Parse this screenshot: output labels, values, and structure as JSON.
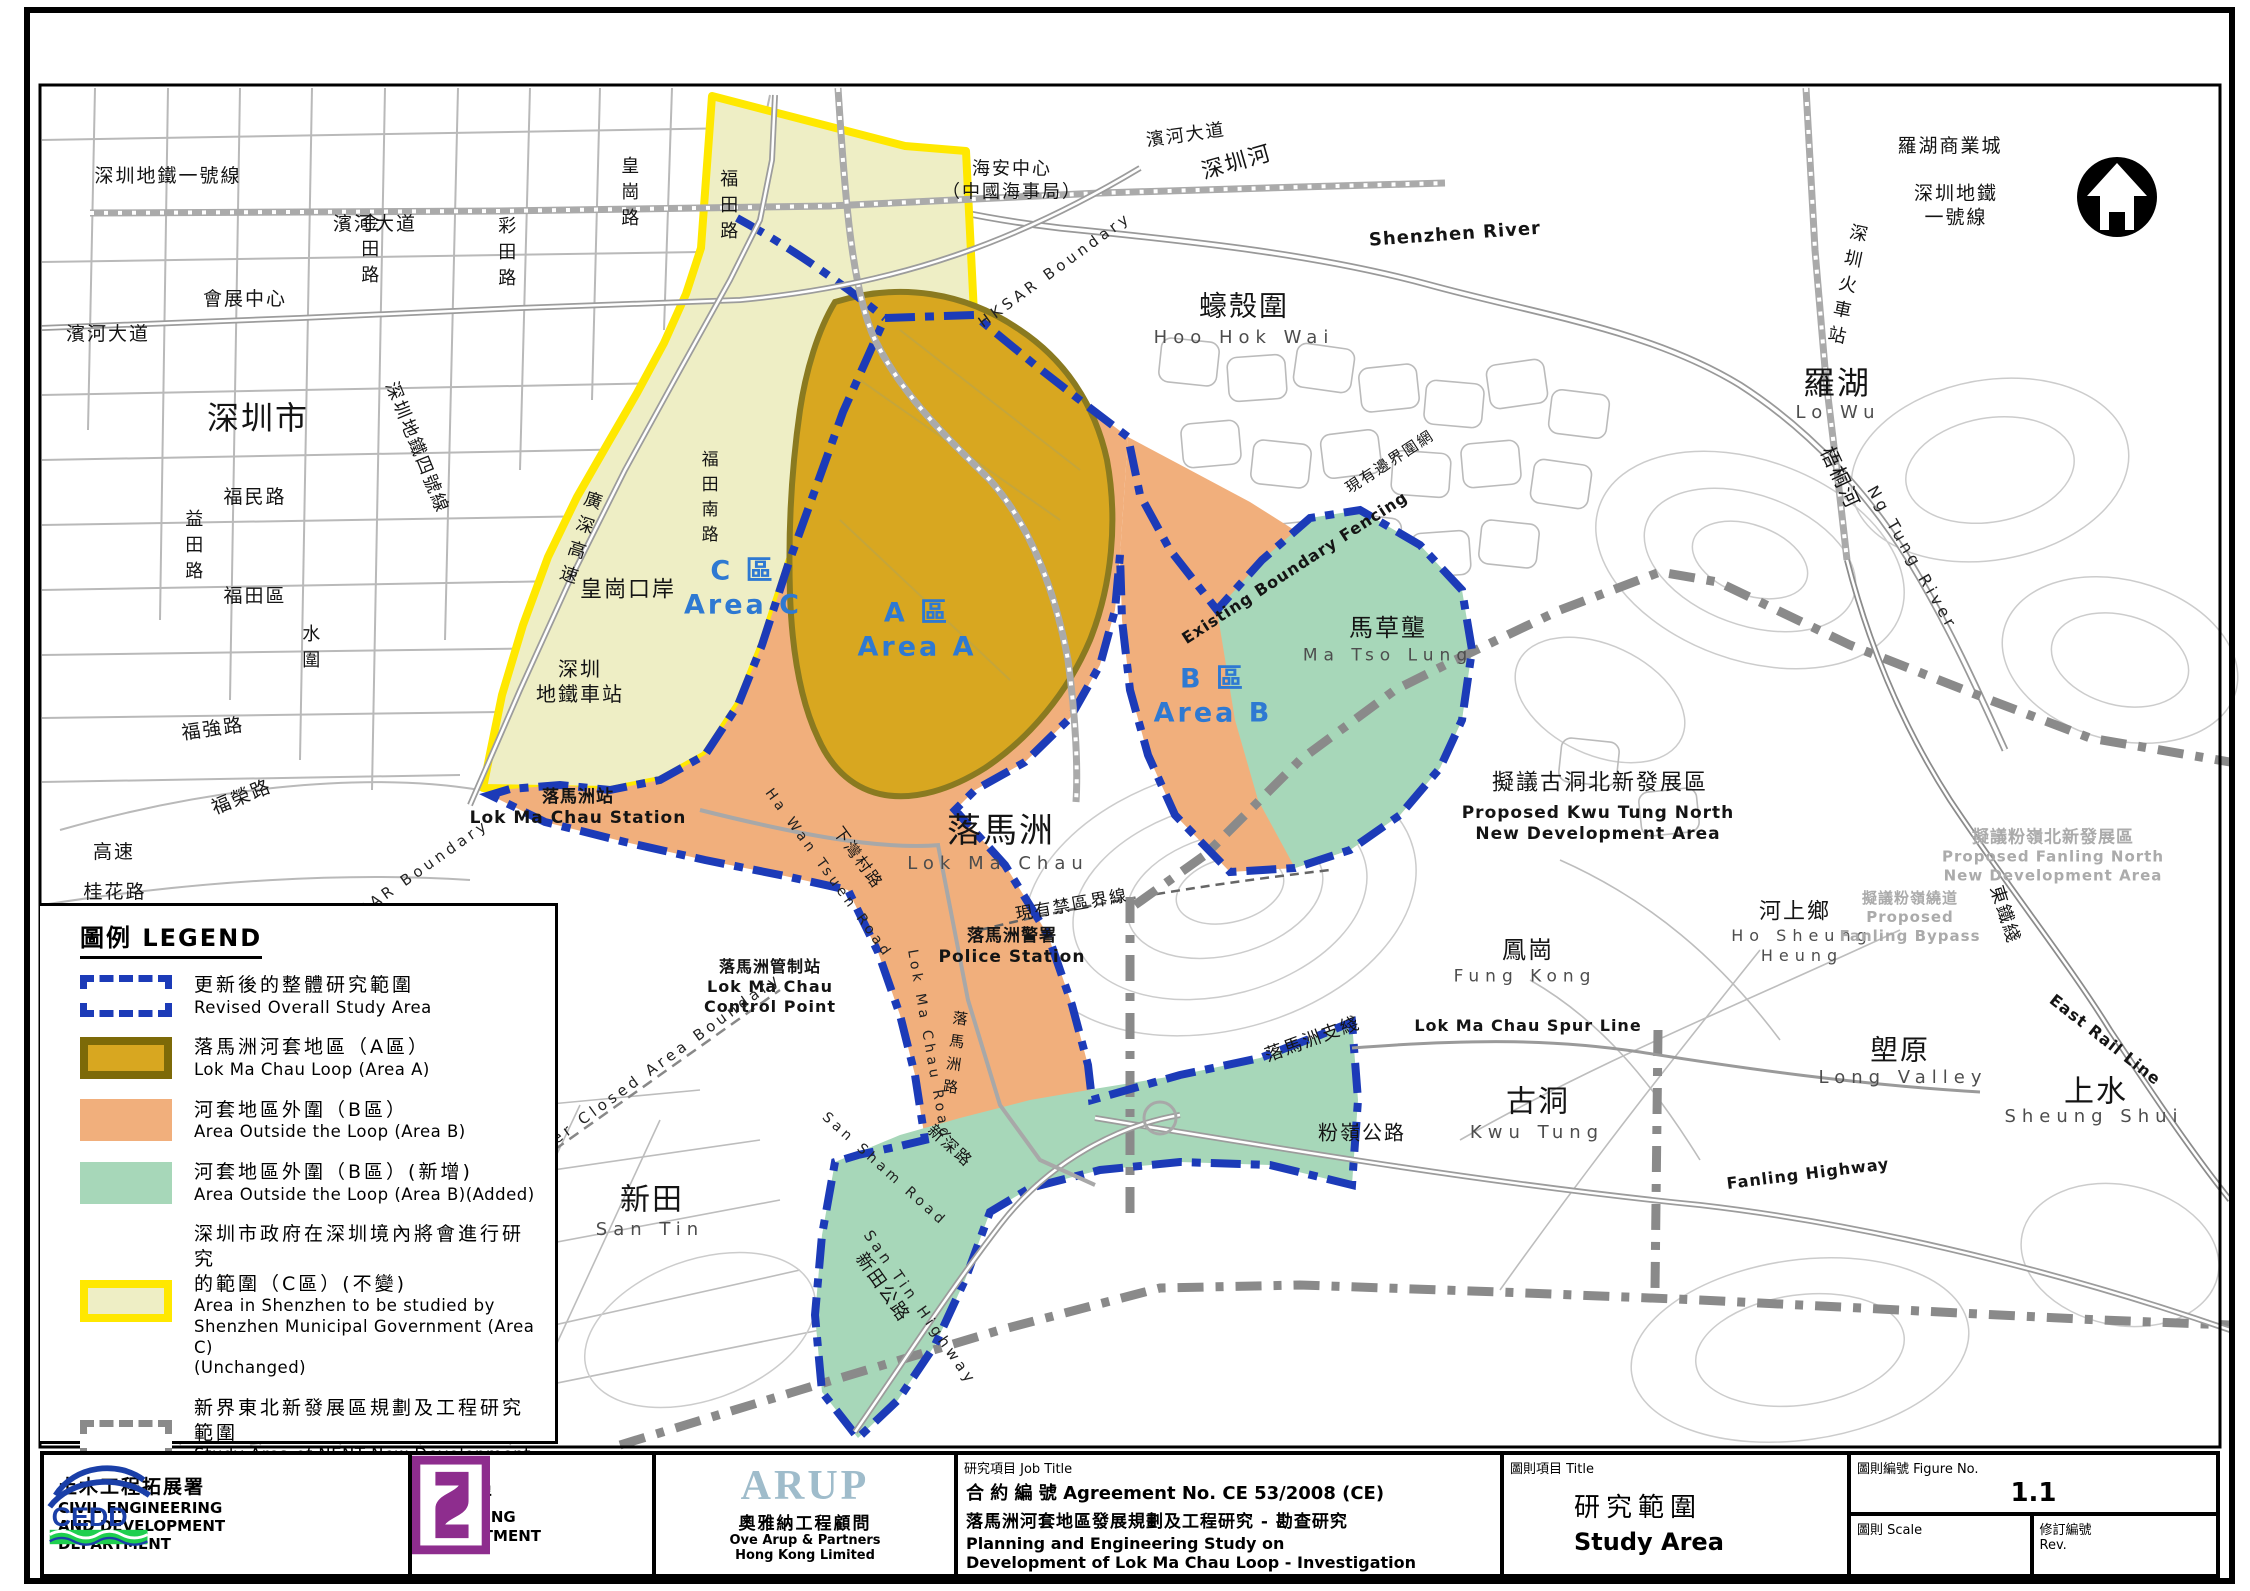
{
  "figure": {
    "number": "1.1"
  },
  "colors": {
    "area_a_fill": "#D8A720",
    "area_a_border": "#7D6A08",
    "area_b_fill": "#F1AF7C",
    "area_b_added_fill": "#A7D7B9",
    "area_c_fill": "#EEEEC5",
    "area_c_border": "#FFE800",
    "study_boundary_blue": "#1C3BB8",
    "nent_boundary_gray": "#8a8a8a",
    "area_label_blue": "#2E79D2"
  },
  "legend": {
    "title": "圖例 LEGEND",
    "items": [
      {
        "swatch": "revised",
        "zh": "更新後的整體研究範圍",
        "en": "Revised Overall Study Area"
      },
      {
        "swatch": "area-a",
        "zh": "落馬洲河套地區（A區）",
        "en": "Lok Ma Chau Loop (Area A)"
      },
      {
        "swatch": "area-b",
        "zh": "河套地區外圍（B區）",
        "en": "Area Outside the Loop (Area B)"
      },
      {
        "swatch": "area-b-added",
        "zh": "河套地區外圍（B區）(新增)",
        "en": "Area Outside the Loop (Area B)(Added)"
      },
      {
        "swatch": "area-c",
        "zh": "深圳市政府在深圳境內將會進行研究\n的範圍（C區）(不變)",
        "en": "Area in Shenzhen to be studied by\nShenzhen Municipal Government (Area C)\n(Unchanged)"
      },
      {
        "swatch": "nent",
        "zh": "新界東北新發展區規劃及工程研究範圍",
        "en": "Study Area of NENT New Development\nAreas Planning and Engineering Study"
      }
    ]
  },
  "title_block": {
    "cedd": {
      "zh": "土木工程拓展署",
      "en": "CIVIL ENGINEERING\nAND DEVELOPMENT\nDEPARTMENT",
      "abbr": "CEDD"
    },
    "planning": {
      "zh": "規劃署",
      "en": "PLANNING\nDEPARTMENT"
    },
    "arup": {
      "word": "ARUP",
      "zh": "奧雅納工程顧問",
      "en": "Ove Arup & Partners\nHong Kong Limited"
    },
    "job": {
      "label": "研究項目 Job Title",
      "agreement": "合 約 編 號 Agreement No. CE 53/2008 (CE)",
      "title_zh": "落馬洲河套地區發展規劃及工程研究 - 勘查研究",
      "title_en": "Planning and Engineering Study on\nDevelopment of Lok Ma Chau Loop - Investigation"
    },
    "drawing": {
      "label": "圖則項目 Title",
      "title_zh": "研究範圍",
      "title_en": "Study Area"
    },
    "figure": {
      "label": "圖則編號 Figure No.",
      "number": "1.1",
      "scale_label": "圖則 Scale",
      "scale_value": "",
      "rev_label": "修訂編號\nRev.",
      "rev_value": ""
    }
  },
  "map": {
    "labels": [
      {
        "id": "sz-metro-line-1",
        "text": "深圳地鐵一號線",
        "x": 168,
        "y": 177
      },
      {
        "id": "kam-tin-road",
        "text": "金田路",
        "x": 368,
        "y": 252,
        "cls": "vert",
        "fs": 18
      },
      {
        "id": "choi-tin-road",
        "text": "彩田路",
        "x": 505,
        "y": 255,
        "cls": "vert",
        "fs": 18
      },
      {
        "id": "wong-kong-road",
        "text": "皇崗路",
        "x": 628,
        "y": 195,
        "cls": "vert",
        "fs": 18
      },
      {
        "id": "fu-tin-road",
        "text": "福田路",
        "x": 727,
        "y": 208,
        "cls": "vert",
        "fs": 18
      },
      {
        "id": "convention-centre",
        "text": "會展中心",
        "x": 245,
        "y": 300
      },
      {
        "id": "binhe-blvd-west",
        "text": "濱河大道",
        "x": 108,
        "y": 335
      },
      {
        "id": "binhe-blvd-centre",
        "text": "濱河大道",
        "x": 375,
        "y": 225
      },
      {
        "id": "shenzhen-city",
        "text": "深圳市",
        "x": 258,
        "y": 418,
        "fs": 32
      },
      {
        "id": "fumin-road",
        "text": "福民路",
        "x": 255,
        "y": 498
      },
      {
        "id": "yitian-road",
        "text": "益田路",
        "x": 192,
        "y": 548,
        "cls": "vert",
        "fs": 18
      },
      {
        "id": "futian-district",
        "text": "福田區",
        "x": 255,
        "y": 597
      },
      {
        "id": "shui-wai",
        "text": "水圍",
        "x": 309,
        "y": 650,
        "cls": "vert",
        "fs": 18
      },
      {
        "id": "sz-metro-line-4",
        "text": "深圳地鐵四號線",
        "x": 416,
        "y": 448,
        "rot": 68,
        "fs": 18
      },
      {
        "id": "fuqiang-road",
        "text": "福強路",
        "x": 213,
        "y": 730,
        "rot": -8
      },
      {
        "id": "furong-road",
        "text": "福榮路",
        "x": 242,
        "y": 798,
        "rot": -22
      },
      {
        "id": "gaosu",
        "text": "高速",
        "x": 114,
        "y": 853
      },
      {
        "id": "guihua-road",
        "text": "桂花路",
        "x": 115,
        "y": 893
      },
      {
        "id": "guangshen-expressway",
        "text": "廣深高速",
        "x": 578,
        "y": 540,
        "cls": "vert",
        "rot": 18,
        "fs": 18
      },
      {
        "id": "futian-south-road",
        "text": "福田南路",
        "x": 707,
        "y": 500,
        "cls": "vert",
        "fs": 17
      },
      {
        "id": "hai-an-centre",
        "text": "海安中心\n（中國海事局）",
        "x": 1012,
        "y": 181,
        "fs": 18
      },
      {
        "id": "binhe-blvd-east",
        "text": "濱河大道",
        "x": 1186,
        "y": 136,
        "rot": -8,
        "fs": 18
      },
      {
        "id": "shenzhen-river-cjk",
        "text": "深圳河",
        "x": 1237,
        "y": 163,
        "rot": -16,
        "fs": 22
      },
      {
        "id": "shenzhen-river-en",
        "text": "Shenzhen River",
        "x": 1455,
        "y": 235,
        "rot": -4,
        "cls": "bold",
        "fs": 18
      },
      {
        "id": "hksar-boundary-north",
        "text": "HKSAR Boundary",
        "x": 1055,
        "y": 270,
        "rot": -36,
        "cls": "sp",
        "fs": 15
      },
      {
        "id": "hoo-hok-wai-cjk",
        "text": "蠔殼圍",
        "x": 1244,
        "y": 306,
        "fs": 28
      },
      {
        "id": "hoo-hok-wai-en",
        "text": "Hoo Hok Wai",
        "x": 1244,
        "y": 338,
        "cls": "thin",
        "fs": 18
      },
      {
        "id": "lo-wu-commercial-city",
        "text": "羅湖商業城",
        "x": 1950,
        "y": 147
      },
      {
        "id": "sz-metro-line-1-east",
        "text": "深圳地鐵\n一號線",
        "x": 1956,
        "y": 206
      },
      {
        "id": "sz-railway-station",
        "text": "深圳火車站",
        "x": 1845,
        "y": 287,
        "cls": "vert",
        "rot": 12,
        "fs": 18
      },
      {
        "id": "lo-wu-cjk",
        "text": "羅湖",
        "x": 1837,
        "y": 383,
        "fs": 32
      },
      {
        "id": "lo-wu-en",
        "text": "Lo Wu",
        "x": 1838,
        "y": 413,
        "cls": "thin",
        "fs": 18
      },
      {
        "id": "ng-tung-river-cjk",
        "text": "梧桐河",
        "x": 1840,
        "y": 478,
        "rot": 65,
        "fs": 20
      },
      {
        "id": "ng-tung-river-en",
        "text": "Ng Tung River",
        "x": 1912,
        "y": 558,
        "rot": 60,
        "cls": "sp",
        "fs": 16
      },
      {
        "id": "area-c",
        "text": "C 區\nArea C",
        "x": 743,
        "y": 588,
        "cls": "blue",
        "fs": 27
      },
      {
        "id": "area-a",
        "text": "A 區\nArea A",
        "x": 917,
        "y": 630,
        "cls": "blue",
        "fs": 27
      },
      {
        "id": "area-b",
        "text": "B 區\nArea B",
        "x": 1213,
        "y": 696,
        "cls": "blue",
        "fs": 27
      },
      {
        "id": "huanggang-port",
        "text": "皇崗口岸",
        "x": 628,
        "y": 590,
        "fs": 22
      },
      {
        "id": "sz-metro-terminus",
        "text": "深圳\n地鐵車站",
        "x": 580,
        "y": 682,
        "fs": 20
      },
      {
        "id": "lok-ma-chau-station",
        "text": "落馬洲站\nLok Ma Chau Station",
        "x": 578,
        "y": 808,
        "cls": "bold",
        "fs": 17
      },
      {
        "id": "existing-fence-cjk",
        "text": "現有邊界圍網",
        "x": 1390,
        "y": 462,
        "rot": -33,
        "fs": 15
      },
      {
        "id": "existing-fence-en",
        "text": "Existing Boundary Fencing",
        "x": 1295,
        "y": 568,
        "rot": -33,
        "cls": "bold",
        "fs": 16
      },
      {
        "id": "ma-tso-lung-cjk",
        "text": "馬草壟",
        "x": 1388,
        "y": 628,
        "fs": 24
      },
      {
        "id": "ma-tso-lung-en",
        "text": "Ma Tso Lung",
        "x": 1388,
        "y": 656,
        "cls": "thin",
        "fs": 17
      },
      {
        "id": "kwu-tung-north-nda-cjk",
        "text": "擬議古洞北新發展區",
        "x": 1600,
        "y": 783,
        "fs": 22
      },
      {
        "id": "kwu-tung-north-nda-en",
        "text": "Proposed Kwu Tung North\nNew Development Area",
        "x": 1598,
        "y": 824,
        "cls": "bold",
        "fs": 17
      },
      {
        "id": "lok-ma-chau-cjk",
        "text": "落馬洲",
        "x": 1001,
        "y": 831,
        "fs": 34
      },
      {
        "id": "lok-ma-chau-en",
        "text": "Lok Ma Chau",
        "x": 998,
        "y": 864,
        "cls": "thin",
        "fs": 18
      },
      {
        "id": "ha-wan-tsuen-road-cjk",
        "text": "下灣村路",
        "x": 858,
        "y": 858,
        "rot": 54,
        "fs": 16
      },
      {
        "id": "ha-wan-tsuen-road-en",
        "text": "Ha Wan Tsuen Road",
        "x": 828,
        "y": 874,
        "rot": 54,
        "cls": "sp",
        "fs": 14
      },
      {
        "id": "closed-area-line",
        "text": "現有禁區界線",
        "x": 1072,
        "y": 906,
        "rot": -10,
        "fs": 17
      },
      {
        "id": "lmc-police-station",
        "text": "落馬洲警署\nPolice Station",
        "x": 1012,
        "y": 947,
        "cls": "bold",
        "fs": 17
      },
      {
        "id": "lmc-control-point",
        "text": "落馬洲管制站\nLok Ma Chau\nControl Point",
        "x": 770,
        "y": 987,
        "cls": "bold",
        "fs": 16
      },
      {
        "id": "hksar-boundary-west",
        "text": "HKSAR Boundary",
        "x": 412,
        "y": 876,
        "rot": -35,
        "cls": "sp",
        "fs": 15
      },
      {
        "id": "frontier-closed-area",
        "text": "Frontier Closed Area Boundary",
        "x": 640,
        "y": 1078,
        "rot": -36,
        "cls": "sp",
        "fs": 15
      },
      {
        "id": "lok-ma-chau-road-cjk",
        "text": "落馬洲路",
        "x": 954,
        "y": 1056,
        "cls": "vert",
        "rot": 8,
        "fs": 15
      },
      {
        "id": "lok-ma-chau-road-en",
        "text": "Lok Ma Chau Road",
        "x": 928,
        "y": 1045,
        "rot": 80,
        "cls": "sp",
        "fs": 14
      },
      {
        "id": "san-sham-road-cjk",
        "text": "新深路",
        "x": 950,
        "y": 1146,
        "rot": 42,
        "fs": 16
      },
      {
        "id": "san-sham-road-en",
        "text": "San Sham Road",
        "x": 884,
        "y": 1170,
        "rot": 42,
        "cls": "sp",
        "fs": 14
      },
      {
        "id": "san-tin-cjk",
        "text": "新田",
        "x": 652,
        "y": 1200,
        "fs": 30
      },
      {
        "id": "san-tin-en",
        "text": "San Tin",
        "x": 650,
        "y": 1230,
        "cls": "thin",
        "fs": 18
      },
      {
        "id": "san-tin-highway-cjk",
        "text": "新田公路",
        "x": 882,
        "y": 1288,
        "rot": 55,
        "fs": 18
      },
      {
        "id": "san-tin-highway-en",
        "text": "San Tin Highway",
        "x": 920,
        "y": 1308,
        "rot": 55,
        "cls": "sp",
        "fs": 15
      },
      {
        "id": "lmc-spur-line-cjk",
        "text": "落馬洲支綫",
        "x": 1313,
        "y": 1040,
        "rot": -20,
        "fs": 18
      },
      {
        "id": "fanling-highway-cjk",
        "text": "粉嶺公路",
        "x": 1362,
        "y": 1133,
        "fs": 20
      },
      {
        "id": "fung-kong-cjk",
        "text": "鳳崗",
        "x": 1528,
        "y": 950,
        "fs": 24
      },
      {
        "id": "fung-kong-en",
        "text": "Fung Kong",
        "x": 1525,
        "y": 977,
        "cls": "thin",
        "fs": 17
      },
      {
        "id": "lmc-spur-line-en",
        "text": "Lok Ma Chau Spur Line",
        "x": 1528,
        "y": 1026,
        "cls": "bold",
        "fs": 16
      },
      {
        "id": "kwu-tung-cjk",
        "text": "古洞",
        "x": 1538,
        "y": 1102,
        "fs": 30
      },
      {
        "id": "kwu-tung-en",
        "text": "Kwu Tung",
        "x": 1537,
        "y": 1133,
        "cls": "thin",
        "fs": 18
      },
      {
        "id": "ho-sheung-heung-cjk",
        "text": "河上鄉",
        "x": 1795,
        "y": 912,
        "fs": 22
      },
      {
        "id": "ho-sheung-heung-en",
        "text": "Ho Sheung\nHeung",
        "x": 1802,
        "y": 946,
        "cls": "thin",
        "fs": 16
      },
      {
        "id": "fanling-north-nda-cjk",
        "text": "擬議粉嶺北新發展區",
        "x": 2053,
        "y": 838,
        "cls": "gray",
        "fs": 17
      },
      {
        "id": "fanling-north-nda-en",
        "text": "Proposed Fanling North\nNew Development Area",
        "x": 2053,
        "y": 866,
        "cls": "gray",
        "fs": 15
      },
      {
        "id": "fanling-bypass",
        "text": "擬議粉嶺繞道\nProposed\nFanling Bypass",
        "x": 1910,
        "y": 917,
        "cls": "gray",
        "fs": 15
      },
      {
        "id": "east-rail-cjk",
        "text": "東鐵綫",
        "x": 2004,
        "y": 915,
        "rot": 72,
        "fs": 18
      },
      {
        "id": "east-rail-en",
        "text": "East Rail Line",
        "x": 2105,
        "y": 1040,
        "rot": 38,
        "cls": "bold",
        "fs": 16
      },
      {
        "id": "long-valley-cjk",
        "text": "塱原",
        "x": 1900,
        "y": 1050,
        "fs": 28
      },
      {
        "id": "long-valley-en",
        "text": "Long Valley",
        "x": 1903,
        "y": 1078,
        "cls": "thin",
        "fs": 18
      },
      {
        "id": "sheung-shui-cjk",
        "text": "上水",
        "x": 2096,
        "y": 1092,
        "fs": 30
      },
      {
        "id": "sheung-shui-en",
        "text": "Sheung Shui",
        "x": 2094,
        "y": 1117,
        "cls": "thin",
        "fs": 18
      },
      {
        "id": "fanling-highway-en",
        "text": "Fanling Highway",
        "x": 1808,
        "y": 1174,
        "rot": -7,
        "cls": "bold",
        "fs": 16
      }
    ]
  }
}
